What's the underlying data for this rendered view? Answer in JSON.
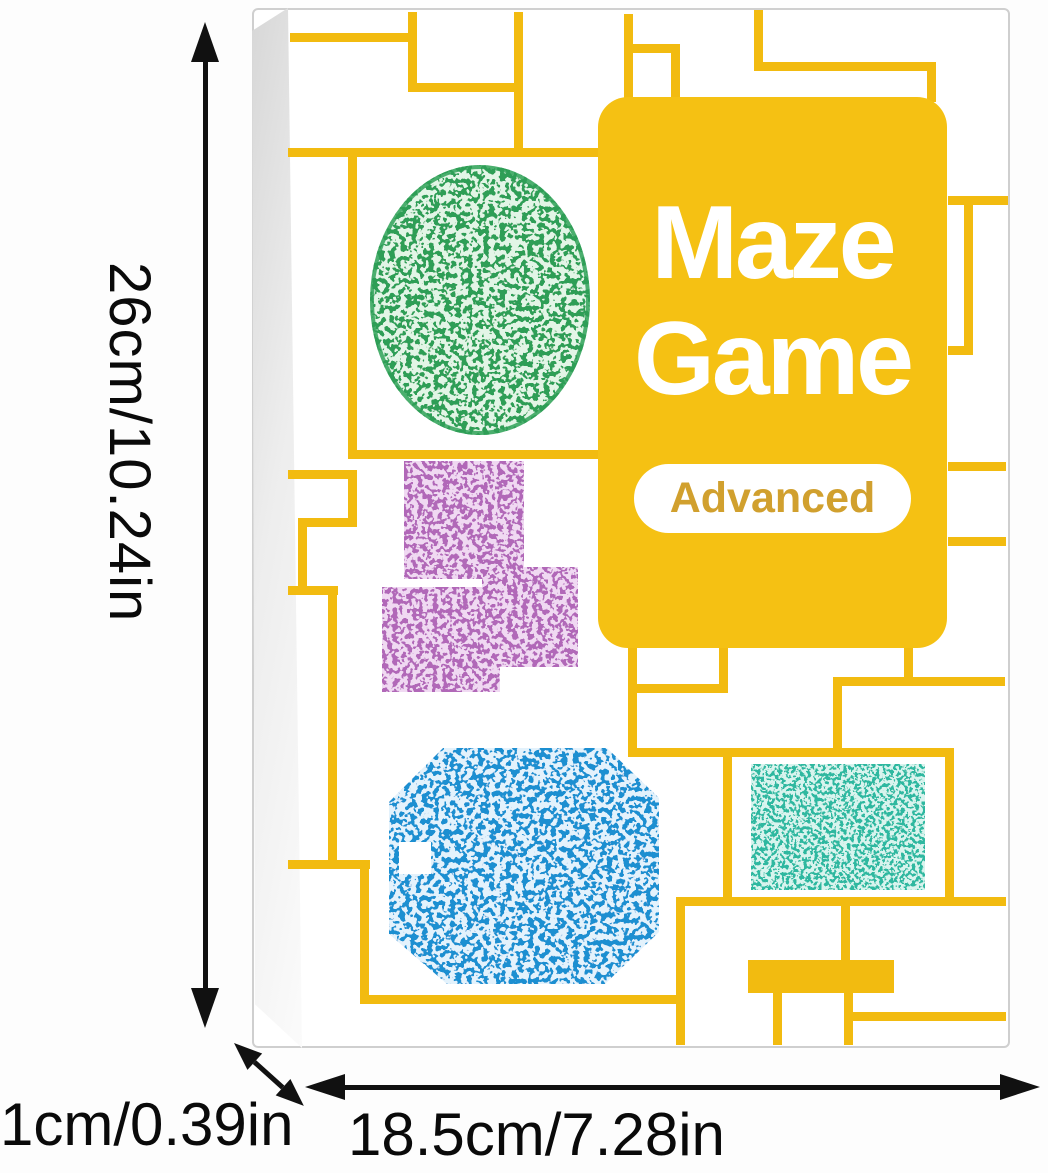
{
  "product": {
    "title_line1": "Maze",
    "title_line2": "Game",
    "badge": "Advanced"
  },
  "dimensions": {
    "height_label": "26cm/10.24in",
    "depth_label": "1cm/0.39in",
    "width_label": "18.5cm/7.28in"
  },
  "colors": {
    "panel_yellow": "#F5C113",
    "line_yellow": "#F2BB10",
    "badge_text_gold": "#D1A02E",
    "maze_green": "#2F9E57",
    "maze_purple": "#B168B8",
    "maze_blue": "#1D8FD1",
    "maze_teal": "#2FB8A0",
    "arrow_black": "#111111"
  }
}
